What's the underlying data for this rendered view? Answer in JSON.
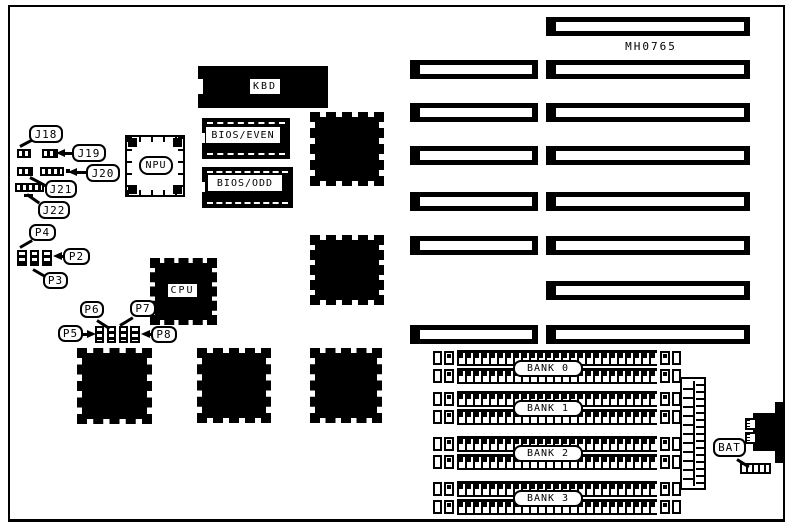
{
  "diagram": {
    "part_number": "MH0765",
    "chips": {
      "kbd": "KBD",
      "bios_even": "BIOS/EVEN",
      "bios_odd": "BIOS/ODD",
      "npu": "NPU",
      "cpu": "CPU"
    },
    "jumpers": {
      "j18": "J18",
      "j19": "J19",
      "j20": "J20",
      "j21": "J21",
      "j22": "J22"
    },
    "pin_headers": {
      "p2": "P2",
      "p3": "P3",
      "p4": "P4",
      "p5": "P5",
      "p6": "P6",
      "p7": "P7",
      "p8": "P8"
    },
    "memory_banks": {
      "bank0": "BANK 0",
      "bank1": "BANK 1",
      "bank2": "BANK 2",
      "bank3": "BANK 3"
    },
    "battery": "BAT",
    "colors": {
      "ink": "#000000",
      "paper": "#ffffff"
    }
  }
}
